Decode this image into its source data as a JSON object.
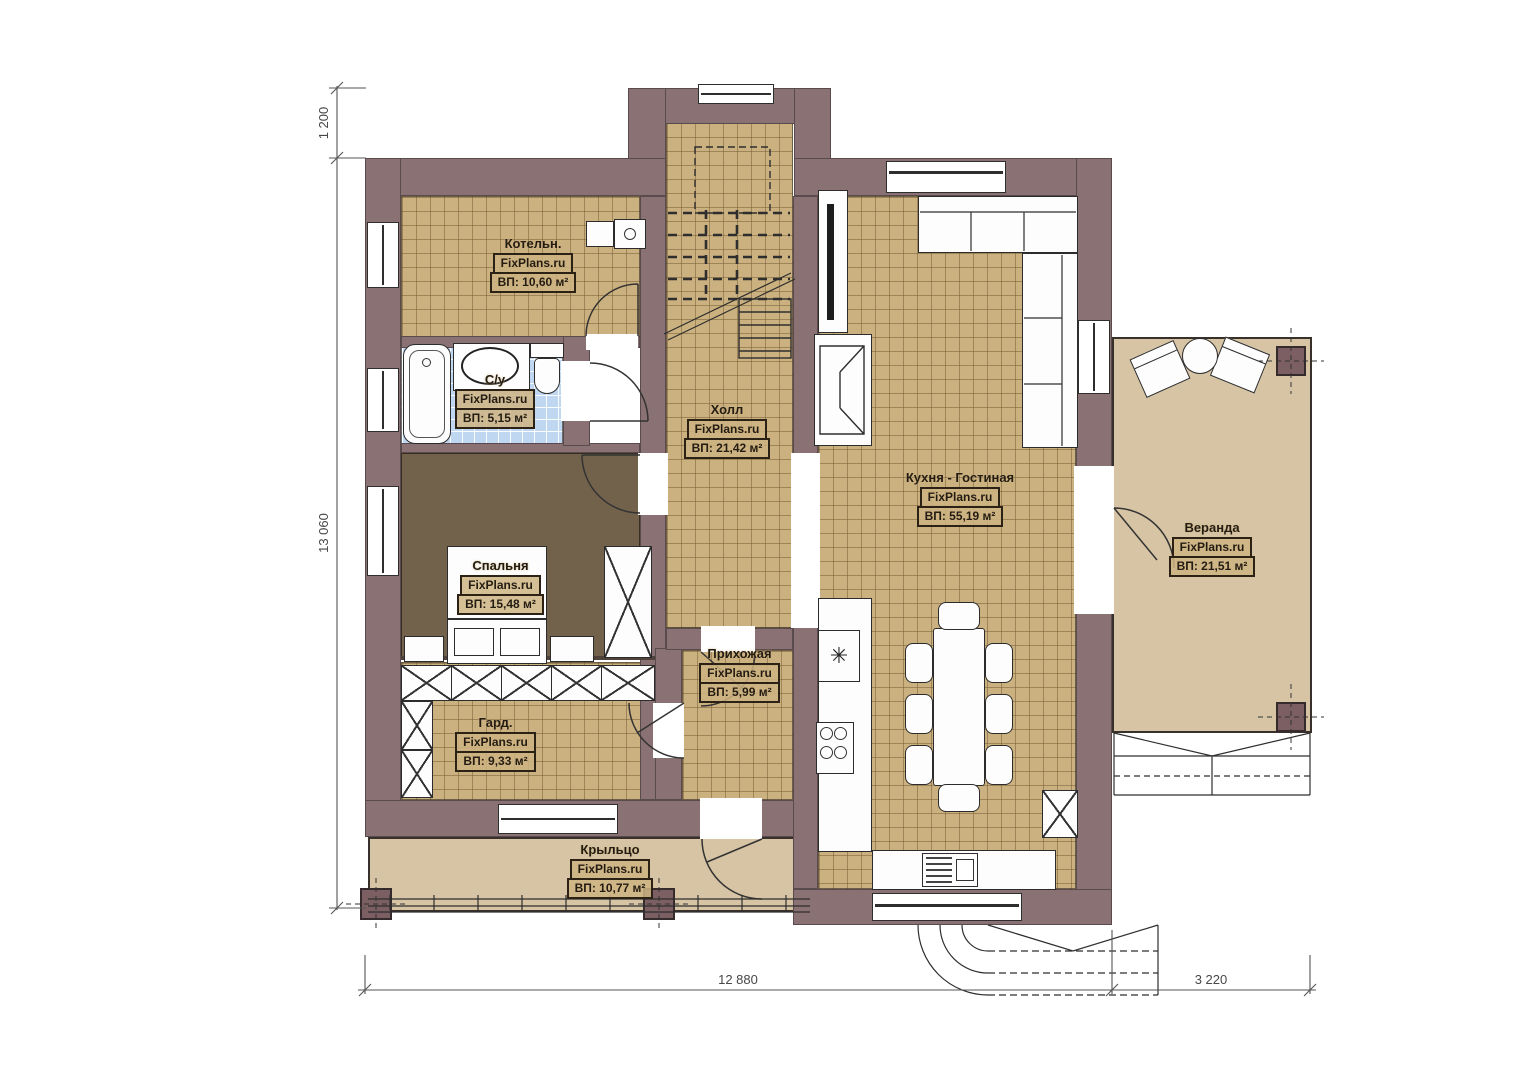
{
  "watermark": "FixPlans.ru",
  "rooms": [
    {
      "name": "Котельн.",
      "area": "ВП: 10,60 м²"
    },
    {
      "name": "С/у",
      "area": "ВП: 5,15 м²"
    },
    {
      "name": "Холл",
      "area": "ВП: 21,42 м²"
    },
    {
      "name": "Спальня",
      "area": "ВП: 15,48 м²"
    },
    {
      "name": "Гард.",
      "area": "ВП: 9,33 м²"
    },
    {
      "name": "Прихожая",
      "area": "ВП: 5,99 м²"
    },
    {
      "name": "Кухня - Гостиная",
      "area": "ВП: 55,19 м²"
    },
    {
      "name": "Веранда",
      "area": "ВП: 21,51 м²"
    },
    {
      "name": "Крыльцо",
      "area": "ВП: 10,77 м²"
    }
  ],
  "dimensions": {
    "left_top": "1 200",
    "left": "13 060",
    "bottom": "12 880",
    "bottom_right": "3 220"
  },
  "icons": {
    "sink-symbol": "✳"
  },
  "colors": {
    "wall": "#8a7173",
    "tile_floor": "#cbb17f",
    "bath_tile": "#bfd7f0",
    "bedroom_floor": "#73624b",
    "deck_floor": "#d6c4a4"
  }
}
